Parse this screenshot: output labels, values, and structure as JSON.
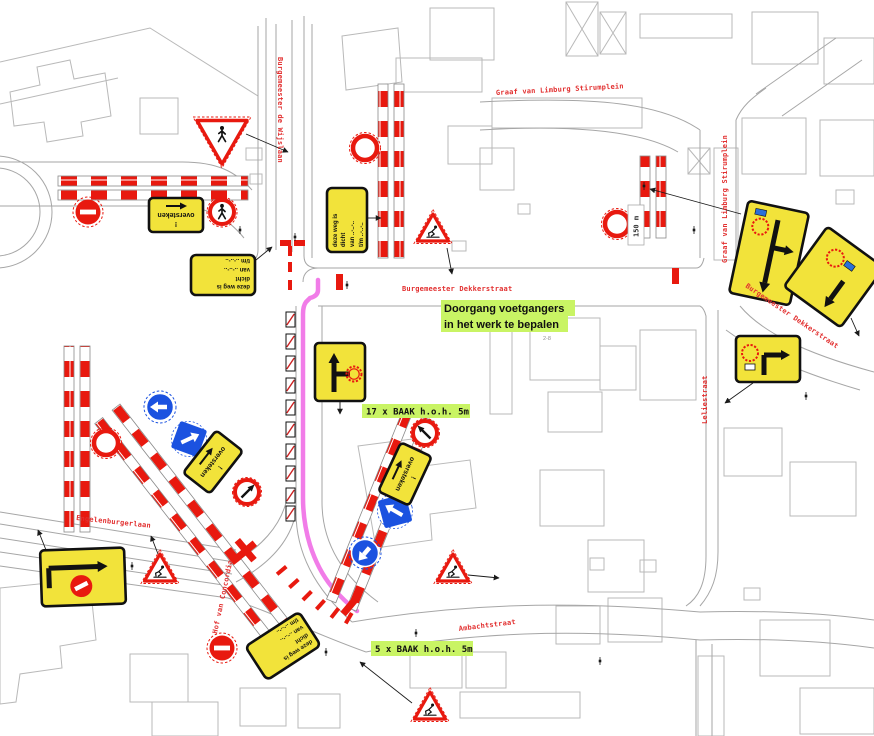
{
  "map": {
    "streets": {
      "burgemeester_de_wijslaan": "Burgemeester de Wijslaan",
      "graaf_van_limburg_stirumplein_top": "Graaf van Limburg Stirumplein",
      "graaf_van_limburg_stirumplein_right": "Graaf van Limburg Stirumplein",
      "burgemeester_dekkerstraat_center": "Burgemeester Dekkerstraat",
      "burgemeester_dekkerstraat_right": "Burgemeester Dekkerstraat",
      "leliestraat": "Leliestraat",
      "engelenburgerlaan": "Engelenburgerlaan",
      "ambachtstraat": "Ambachtstraat",
      "hof_van_concordia": "Hof van Concordia"
    },
    "annotations": {
      "doorgang_line1": "Doorgang voetgangers",
      "doorgang_line2": "in het werk te bepalen",
      "baak17": "17 x BAAK h.o.h. 5m",
      "baak5": "5 x BAAK h.o.h. 5m",
      "distance_150m": "150 m",
      "house_range": "2-8"
    },
    "sign_texts": {
      "deze_weg": {
        "line1": "deze weg is",
        "line2": "dicht",
        "line3": "van ..-..-..",
        "line4": "t/m ..-..-.."
      },
      "oversteken": {
        "line1": "!",
        "line2": "oversteken"
      }
    },
    "sign_glyphs": {
      "no_entry_sign": "solid red circle with white bar",
      "road_closed_ring_sign": "red ring, white center",
      "roadworks_warning_sign": "red triangle with road worker",
      "yield_pedestrian_sign": "point-down red triangle with pedestrian",
      "pedestrian_ring_sign": "red ring with pedestrian",
      "no_turn_arrow_sign": "red ring with black diagonal arrow",
      "mandatory_direction_circle_sign": "blue circle with white arrow",
      "direction_square_sign": "blue square with white arrow",
      "detour_route_sign": "yellow board with black route arrows and red circle",
      "barrier_fence": "red/white striped fence",
      "baak_unit": "small hatched barrier box",
      "pedestrian_route": "magenta line"
    },
    "colors": {
      "street_label_red": "#e23030",
      "highlight_green": "#c9f464",
      "sign_yellow": "#f2e33a",
      "barrier_red": "#e8190f",
      "route_magenta": "#f06ee6",
      "mandatory_blue": "#1b52e0",
      "map_line_gray": "#b9b9b9"
    }
  }
}
